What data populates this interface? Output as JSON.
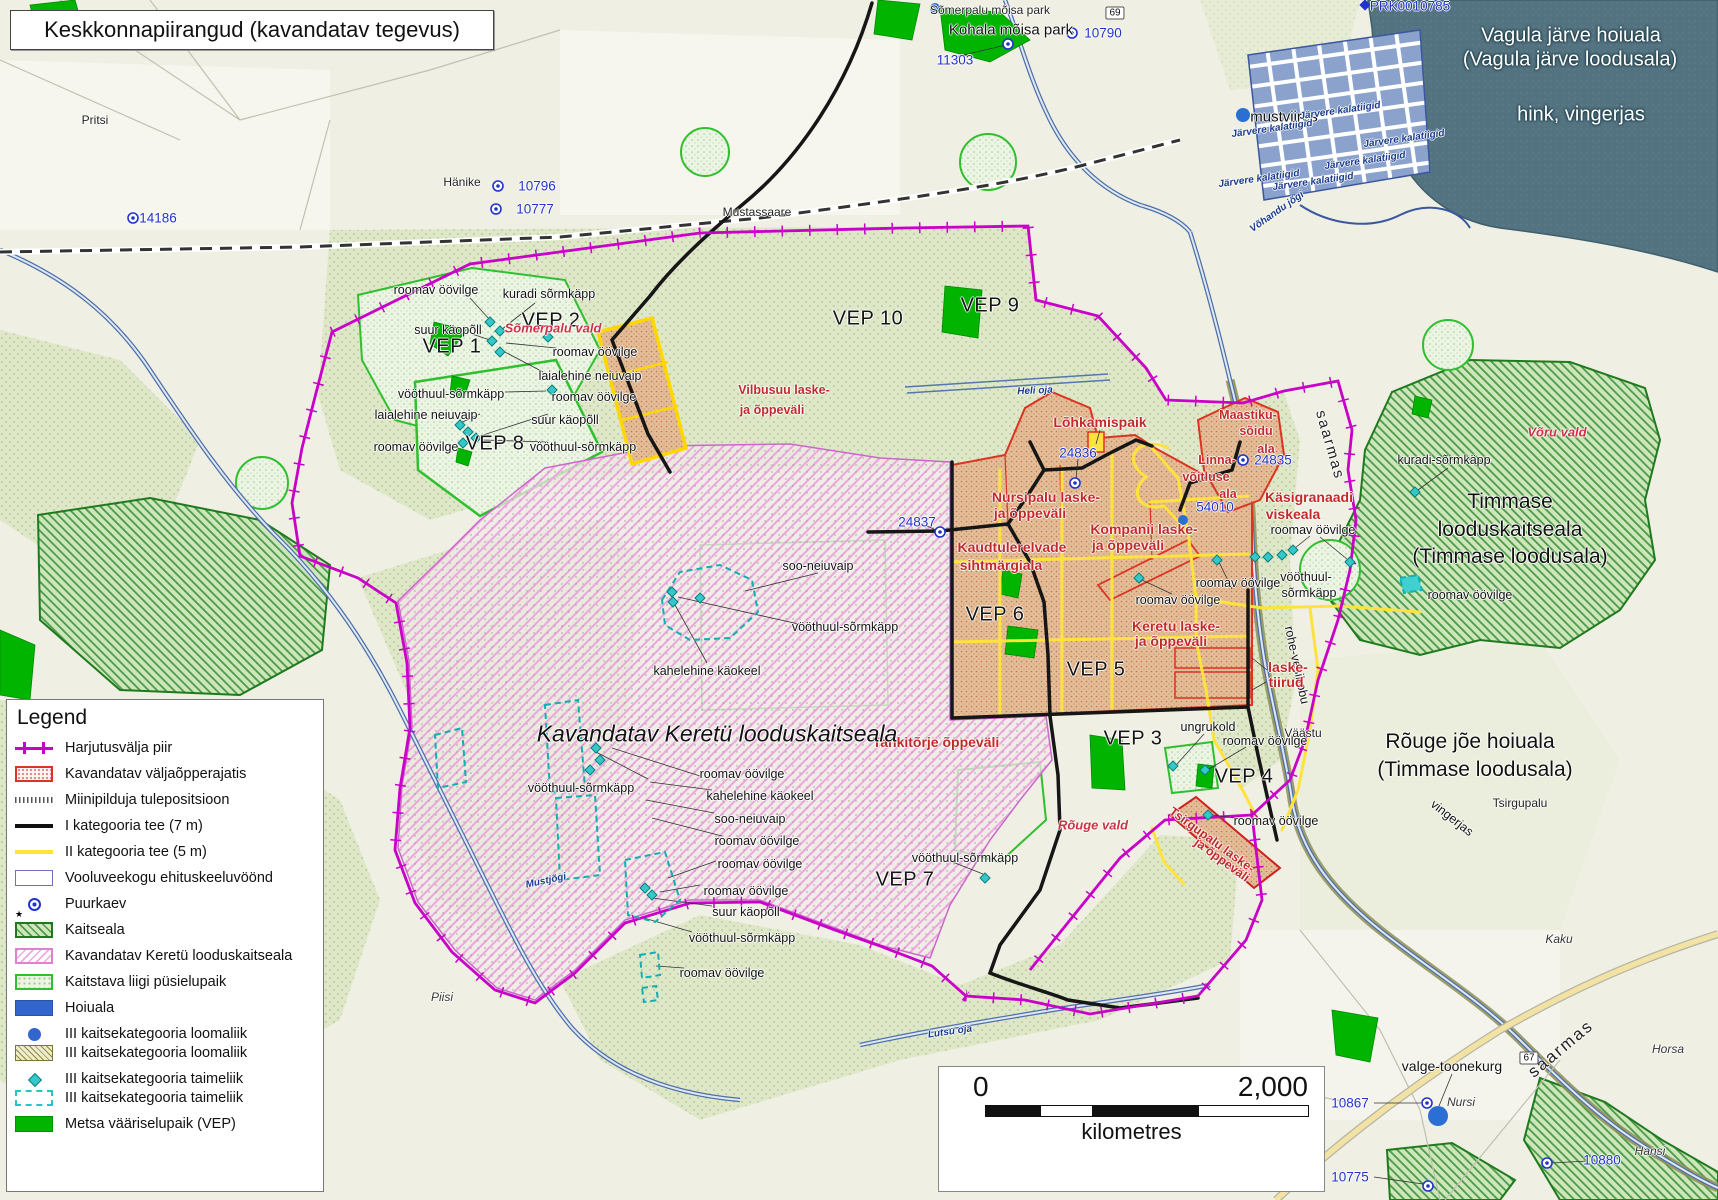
{
  "title": "Keskkonnapiirangud (kavandatav tegevus)",
  "legend": {
    "title": "Legend",
    "items": [
      {
        "swatch": "boundary",
        "label": "Harjutusvälja piir",
        "tight": false
      },
      {
        "swatch": "rajatis",
        "label": "Kavandatav väljaõpperajatis",
        "tight": false
      },
      {
        "swatch": "miini",
        "label": "Miinipilduja tulepositsioon",
        "tight": false
      },
      {
        "swatch": "tee1",
        "label": "I kategooria tee (7 m)",
        "tight": false
      },
      {
        "swatch": "tee2",
        "label": "II kategooria tee (5 m)",
        "tight": false
      },
      {
        "swatch": "voolu",
        "label": "Vooluveekogu ehituskeeluvöönd",
        "tight": false
      },
      {
        "swatch": "puurkaev",
        "label": "Puurkaev",
        "tight": false
      },
      {
        "swatch": "kaitseala",
        "label": "Kaitseala",
        "tight": false
      },
      {
        "swatch": "keretu",
        "label": "Kavandatav Keretü looduskaitseala",
        "tight": false
      },
      {
        "swatch": "pysielu",
        "label": "Kaitstava liigi püsielupaik",
        "tight": false
      },
      {
        "swatch": "hoiuala",
        "label": "Hoiuala",
        "tight": false
      },
      {
        "swatch": "loom1",
        "label": "III kaitsekategooria loomaliik",
        "tight": false
      },
      {
        "swatch": "loom2",
        "label": "III kaitsekategooria loomaliik",
        "tight": true
      },
      {
        "swatch": "taim1",
        "label": "III kaitsekategooria taimeliik",
        "tight": false
      },
      {
        "swatch": "taim2",
        "label": "III kaitsekategooria taimeliik",
        "tight": true
      },
      {
        "swatch": "vep",
        "label": "Metsa vääriselupaik (VEP)",
        "tight": false
      }
    ]
  },
  "scalebar": {
    "zero": "0",
    "max": "2,000",
    "unit": "kilometres"
  },
  "map": {
    "labels": [
      {
        "t": "roomav öövilge",
        "x": 436,
        "y": 290,
        "c": "sp"
      },
      {
        "t": "kuradi sõrmkäpp",
        "x": 549,
        "y": 294,
        "c": "sp"
      },
      {
        "t": "suur käopõll",
        "x": 448,
        "y": 330,
        "c": "sp"
      },
      {
        "t": "roomav öövilge",
        "x": 595,
        "y": 352,
        "c": "sp"
      },
      {
        "t": "laialehine neiuvaip",
        "x": 590,
        "y": 376,
        "c": "sp"
      },
      {
        "t": "vööthuul-sõrmkäpp",
        "x": 451,
        "y": 394,
        "c": "sp"
      },
      {
        "t": "laialehine neiuvaip",
        "x": 426,
        "y": 415,
        "c": "sp"
      },
      {
        "t": "roomav öövilge",
        "x": 594,
        "y": 397,
        "c": "sp"
      },
      {
        "t": "suur käopõll",
        "x": 565,
        "y": 420,
        "c": "sp"
      },
      {
        "t": "roomav öövilge",
        "x": 416,
        "y": 447,
        "c": "sp"
      },
      {
        "t": "vööthuul-sõrmkäpp",
        "x": 583,
        "y": 447,
        "c": "sp"
      },
      {
        "t": "soo-neiuvaip",
        "x": 818,
        "y": 566,
        "c": "sp"
      },
      {
        "t": "vööthuul-sõrmkäpp",
        "x": 845,
        "y": 627,
        "c": "sp"
      },
      {
        "t": "kahelehine käokeel",
        "x": 707,
        "y": 671,
        "c": "sp"
      },
      {
        "t": "vööthuul-sõrmkäpp",
        "x": 581,
        "y": 788,
        "c": "sp"
      },
      {
        "t": "roomav öövilge",
        "x": 742,
        "y": 774,
        "c": "sp"
      },
      {
        "t": "kahelehine käokeel",
        "x": 760,
        "y": 796,
        "c": "sp"
      },
      {
        "t": "soo-neiuvaip",
        "x": 750,
        "y": 819,
        "c": "sp"
      },
      {
        "t": "roomav öövilge",
        "x": 757,
        "y": 841,
        "c": "sp"
      },
      {
        "t": "roomav öövilge",
        "x": 760,
        "y": 864,
        "c": "sp"
      },
      {
        "t": "roomav öövilge",
        "x": 746,
        "y": 891,
        "c": "sp"
      },
      {
        "t": "suur käopõll",
        "x": 746,
        "y": 912,
        "c": "sp"
      },
      {
        "t": "vööthuul-sõrmkäpp",
        "x": 742,
        "y": 938,
        "c": "sp"
      },
      {
        "t": "roomav öövilge",
        "x": 722,
        "y": 973,
        "c": "sp"
      },
      {
        "t": "vööthuul-sõrmkäpp",
        "x": 965,
        "y": 858,
        "c": "sp"
      },
      {
        "t": "roomav öövilge",
        "x": 1178,
        "y": 600,
        "c": "sp"
      },
      {
        "t": "roomav öövilge",
        "x": 1238,
        "y": 583,
        "c": "sp"
      },
      {
        "t": "roomav öövilge",
        "x": 1313,
        "y": 530,
        "c": "sp"
      },
      {
        "t": "vööthuul-",
        "x": 1306,
        "y": 577,
        "c": "sp"
      },
      {
        "t": "sõrmkäpp",
        "x": 1309,
        "y": 593,
        "c": "sp"
      },
      {
        "t": "ungrukold",
        "x": 1208,
        "y": 727,
        "c": "sp"
      },
      {
        "t": "roomav öövilge",
        "x": 1265,
        "y": 741,
        "c": "sp"
      },
      {
        "t": "roomav öövilge",
        "x": 1276,
        "y": 821,
        "c": "sp"
      },
      {
        "t": "kuradi-sõrmkäpp",
        "x": 1444,
        "y": 460,
        "c": "sp"
      },
      {
        "t": "roomav öövilge",
        "x": 1470,
        "y": 595,
        "c": "sp"
      },
      {
        "t": "valge-toonekurg",
        "x": 1452,
        "y": 1066,
        "c": "sp14"
      },
      {
        "t": "rohe-vesihobu",
        "x": 1297,
        "y": 665,
        "c": "sp",
        "r": 78
      },
      {
        "t": "vingerjas",
        "x": 1452,
        "y": 818,
        "c": "sp",
        "r": 38
      },
      {
        "t": "saarmas",
        "x": 1330,
        "y": 445,
        "c": "riv",
        "r": 74
      },
      {
        "t": "saarmas",
        "x": 1561,
        "y": 1049,
        "c": "riv2",
        "r": -40
      },
      {
        "t": "VEP 1",
        "x": 452,
        "y": 347,
        "c": "vep"
      },
      {
        "t": "VEP 2",
        "x": 551,
        "y": 321,
        "c": "vep"
      },
      {
        "t": "VEP 8",
        "x": 495,
        "y": 444,
        "c": "vep"
      },
      {
        "t": "VEP 9",
        "x": 990,
        "y": 306,
        "c": "vep"
      },
      {
        "t": "VEP 10",
        "x": 868,
        "y": 319,
        "c": "vep"
      },
      {
        "t": "VEP 6",
        "x": 995,
        "y": 615,
        "c": "vep"
      },
      {
        "t": "VEP 5",
        "x": 1096,
        "y": 670,
        "c": "vep"
      },
      {
        "t": "VEP 3",
        "x": 1133,
        "y": 739,
        "c": "vep"
      },
      {
        "t": "VEP 4",
        "x": 1244,
        "y": 777,
        "c": "vep"
      },
      {
        "t": "VEP 7",
        "x": 905,
        "y": 880,
        "c": "vep"
      },
      {
        "t": "Vilbusuu laske-",
        "x": 784,
        "y": 390,
        "c": "red-s"
      },
      {
        "t": "ja õppeväli",
        "x": 772,
        "y": 410,
        "c": "red-s"
      },
      {
        "t": "Lõhkamispaik",
        "x": 1100,
        "y": 422,
        "c": "red"
      },
      {
        "t": "Nursipalu laske-",
        "x": 1046,
        "y": 497,
        "c": "red"
      },
      {
        "t": "ja õppeväli",
        "x": 1030,
        "y": 513,
        "c": "red"
      },
      {
        "t": "Kompanii laske-",
        "x": 1144,
        "y": 529,
        "c": "red"
      },
      {
        "t": "ja õppeväli",
        "x": 1128,
        "y": 545,
        "c": "red"
      },
      {
        "t": "Kaudtulerelvade",
        "x": 1012,
        "y": 547,
        "c": "red"
      },
      {
        "t": "sihtmärgiala",
        "x": 1001,
        "y": 565,
        "c": "red"
      },
      {
        "t": "Maastiku-",
        "x": 1248,
        "y": 415,
        "c": "red-s"
      },
      {
        "t": "sõidu",
        "x": 1256,
        "y": 431,
        "c": "red-s"
      },
      {
        "t": "ala",
        "x": 1266,
        "y": 449,
        "c": "red-s"
      },
      {
        "t": "Linna-",
        "x": 1217,
        "y": 460,
        "c": "red-s"
      },
      {
        "t": "võitluse",
        "x": 1206,
        "y": 477,
        "c": "red-s"
      },
      {
        "t": "ala",
        "x": 1228,
        "y": 494,
        "c": "red-s"
      },
      {
        "t": "Käsigranaadi",
        "x": 1309,
        "y": 497,
        "c": "red"
      },
      {
        "t": "viskeala",
        "x": 1293,
        "y": 514,
        "c": "red"
      },
      {
        "t": "Keretu laske-",
        "x": 1176,
        "y": 626,
        "c": "red"
      },
      {
        "t": "ja õppeväli",
        "x": 1171,
        "y": 641,
        "c": "red"
      },
      {
        "t": "laske-",
        "x": 1288,
        "y": 667,
        "c": "red"
      },
      {
        "t": "tiirud",
        "x": 1286,
        "y": 682,
        "c": "red"
      },
      {
        "t": "Tankitõrje õppeväli",
        "x": 936,
        "y": 742,
        "c": "red"
      },
      {
        "t": "Tsirgupalu laske-",
        "x": 1212,
        "y": 840,
        "c": "red-s",
        "r": 36
      },
      {
        "t": "ja õppeväli",
        "x": 1222,
        "y": 860,
        "c": "red-s",
        "r": 36
      },
      {
        "t": "Sõmerpalu vald",
        "x": 553,
        "y": 328,
        "c": "red-i"
      },
      {
        "t": "Rõuge vald",
        "x": 1093,
        "y": 825,
        "c": "red-i"
      },
      {
        "t": "Võru vald",
        "x": 1557,
        "y": 432,
        "c": "red-i"
      },
      {
        "t": "14186",
        "x": 158,
        "y": 218,
        "c": "blue"
      },
      {
        "t": "10796",
        "x": 537,
        "y": 186,
        "c": "blue"
      },
      {
        "t": "10777",
        "x": 535,
        "y": 209,
        "c": "blue"
      },
      {
        "t": "11303",
        "x": 955,
        "y": 60,
        "c": "blue"
      },
      {
        "t": "10790",
        "x": 1103,
        "y": 33,
        "c": "blue"
      },
      {
        "t": "PRK0010785",
        "x": 1410,
        "y": 6,
        "c": "blue"
      },
      {
        "t": "24836",
        "x": 1078,
        "y": 453,
        "c": "blue"
      },
      {
        "t": "24837",
        "x": 917,
        "y": 522,
        "c": "blue"
      },
      {
        "t": "24835",
        "x": 1273,
        "y": 460,
        "c": "blue"
      },
      {
        "t": "54010",
        "x": 1215,
        "y": 507,
        "c": "blue"
      },
      {
        "t": "10867",
        "x": 1350,
        "y": 1103,
        "c": "blue"
      },
      {
        "t": "10775",
        "x": 1350,
        "y": 1177,
        "c": "blue"
      },
      {
        "t": "10880",
        "x": 1602,
        "y": 1160,
        "c": "blue"
      },
      {
        "t": "Pritsi",
        "x": 95,
        "y": 120,
        "c": "place"
      },
      {
        "t": "Hänike",
        "x": 462,
        "y": 182,
        "c": "place"
      },
      {
        "t": "Mustassaare",
        "x": 757,
        "y": 212,
        "c": "place"
      },
      {
        "t": "Kohala mõisa park",
        "x": 1011,
        "y": 30,
        "c": "place-lg"
      },
      {
        "t": "Sõmerpalu mõisa park",
        "x": 990,
        "y": 10,
        "c": "place"
      },
      {
        "t": "mustviires",
        "x": 1284,
        "y": 117,
        "c": "place-lg"
      },
      {
        "t": "Piisi",
        "x": 442,
        "y": 997,
        "c": "place-i"
      },
      {
        "t": "Kaku",
        "x": 1559,
        "y": 939,
        "c": "place-i"
      },
      {
        "t": "Horsa",
        "x": 1668,
        "y": 1049,
        "c": "place-i"
      },
      {
        "t": "Hansi",
        "x": 1650,
        "y": 1151,
        "c": "place-i"
      },
      {
        "t": "Nursi",
        "x": 1461,
        "y": 1102,
        "c": "place-i"
      },
      {
        "t": "Tsirgupalu",
        "x": 1520,
        "y": 803,
        "c": "place"
      },
      {
        "t": "Väästu",
        "x": 1303,
        "y": 733,
        "c": "place"
      },
      {
        "t": "Timmase",
        "x": 1510,
        "y": 502,
        "c": "big"
      },
      {
        "t": "looduskaitseala",
        "x": 1510,
        "y": 530,
        "c": "big"
      },
      {
        "t": "(Timmase loodusala)",
        "x": 1510,
        "y": 557,
        "c": "big"
      },
      {
        "t": "Rõuge jõe hoiuala",
        "x": 1470,
        "y": 742,
        "c": "big"
      },
      {
        "t": "(Timmase loodusala)",
        "x": 1475,
        "y": 770,
        "c": "big"
      },
      {
        "t": "Kavandatav Keretü looduskaitseala",
        "x": 717,
        "y": 734,
        "c": "big-i"
      },
      {
        "t": "Vagula järve hoiuala",
        "x": 1571,
        "y": 36,
        "c": "white"
      },
      {
        "t": "(Vagula järve loodusala)",
        "x": 1570,
        "y": 60,
        "c": "white"
      },
      {
        "t": "hink, vingerjas",
        "x": 1581,
        "y": 115,
        "c": "white"
      },
      {
        "t": "Järvere kalatiigid",
        "x": 1340,
        "y": 111,
        "c": "water",
        "r": -8
      },
      {
        "t": "Järvere kalatiigid",
        "x": 1272,
        "y": 129,
        "c": "water",
        "r": -8
      },
      {
        "t": "Järvere kalatiigid",
        "x": 1404,
        "y": 139,
        "c": "water",
        "r": -8
      },
      {
        "t": "Järvere kalatiigid",
        "x": 1365,
        "y": 161,
        "c": "water",
        "r": -8
      },
      {
        "t": "Järvere kalatiigid",
        "x": 1259,
        "y": 179,
        "c": "water",
        "r": -8
      },
      {
        "t": "Järvere kalatiigid",
        "x": 1313,
        "y": 182,
        "c": "water",
        "r": -8
      },
      {
        "t": "Võhandu jõgi",
        "x": 1277,
        "y": 212,
        "c": "water",
        "r": -35
      },
      {
        "t": "Mustjõgi",
        "x": 546,
        "y": 881,
        "c": "water",
        "r": -12
      },
      {
        "t": "Heli oja",
        "x": 1035,
        "y": 391,
        "c": "water",
        "r": -3
      },
      {
        "t": "Lutsu oja",
        "x": 950,
        "y": 1032,
        "c": "water",
        "r": -8
      },
      {
        "t": "69",
        "x": 1115,
        "y": 13,
        "c": "badge"
      },
      {
        "t": "67",
        "x": 1529,
        "y": 1058,
        "c": "badge"
      }
    ]
  }
}
